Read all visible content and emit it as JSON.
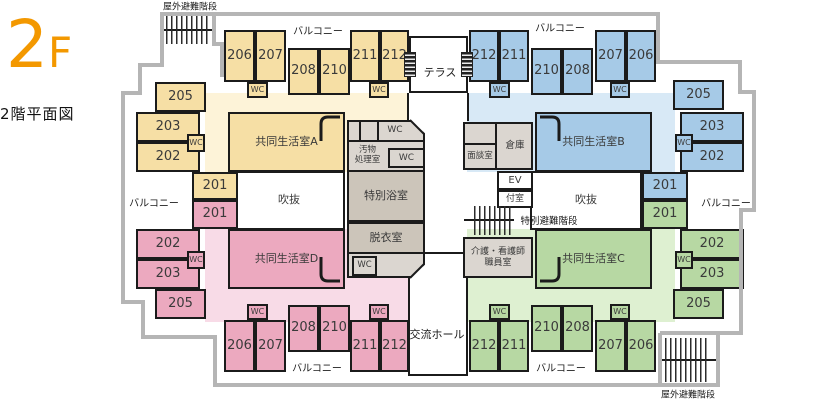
{
  "title": {
    "floor_big": "2",
    "floor_small": "F",
    "caption": "2階平面図"
  },
  "palette": {
    "roomY": "#f6dfa5",
    "tintY": "#fdf3d8",
    "roomB": "#a6cae7",
    "tintB": "#d8e9f6",
    "roomP": "#eca9bf",
    "tintP": "#f8dbe7",
    "roomG": "#b7d8a3",
    "tintG": "#def0d1",
    "grayL": "#dbd6d0",
    "grayD": "#ccc5ba",
    "white": "#ffffff",
    "wall": "#1b1b1b",
    "outline": "#b5b5b5",
    "accent": "#f39800"
  },
  "areas": [
    {
      "id": "himawari",
      "name": "[ひまわり]",
      "suffix": "エリア",
      "color": "#ef8200"
    },
    {
      "id": "tsubaki",
      "name": "[つばき]",
      "suffix": "エリア",
      "color": "#1d6fba"
    },
    {
      "id": "sumire",
      "name": "[すみれ]",
      "suffix": "エリア",
      "color": "#e4007f"
    },
    {
      "id": "tanpopo",
      "name": "[たんぽぽ]",
      "suffix": "エリア",
      "color": "#22a23c"
    }
  ],
  "plan": {
    "rects": [
      {
        "n": "himawari-area-tint",
        "x": 205,
        "y": 93,
        "w": 204,
        "h": 79,
        "f": "tintY"
      },
      {
        "n": "tsubaki-area-tint",
        "x": 467,
        "y": 93,
        "w": 208,
        "h": 79,
        "f": "tintB"
      },
      {
        "n": "sumire-area-tint",
        "x": 205,
        "y": 229,
        "w": 204,
        "h": 93,
        "f": "tintP"
      },
      {
        "n": "tanpopo-area-tint",
        "x": 467,
        "y": 229,
        "w": 208,
        "h": 93,
        "f": "tintG"
      },
      {
        "n": "terrace",
        "x": 409,
        "y": 36,
        "w": 59,
        "h": 57,
        "f": "white",
        "b": 1
      },
      {
        "n": "atrium-left",
        "t": "吹抜",
        "x": 233,
        "y": 171,
        "w": 112,
        "h": 59,
        "f": "white",
        "fs": 11,
        "b": 1
      },
      {
        "n": "atrium-right",
        "t": "吹抜",
        "x": 530,
        "y": 171,
        "w": 112,
        "h": 59,
        "f": "white",
        "fs": 11,
        "b": 1
      },
      {
        "n": "exchange-hall",
        "x": 408,
        "y": 252,
        "w": 60,
        "h": 124,
        "f": "white",
        "b": 1
      },
      {
        "n": "elevator",
        "t": "EV",
        "x": 497,
        "y": 171,
        "w": 36,
        "h": 19,
        "f": "white",
        "fs": 10,
        "b": 1
      },
      {
        "n": "anteroom",
        "t": "付室",
        "x": 497,
        "y": 190,
        "w": 36,
        "h": 18,
        "f": "white",
        "fs": 9,
        "b": 1
      },
      {
        "n": "sanitary-block",
        "x": 347,
        "y": 120,
        "w": 78,
        "h": 158,
        "f": "grayL",
        "b": 1,
        "clip": "sani"
      },
      {
        "n": "sanitary-row1-wall",
        "x": 347,
        "y": 140,
        "w": 78,
        "h": 2,
        "f": "wall"
      },
      {
        "n": "sanitary-divider-1",
        "x": 359,
        "y": 120,
        "w": 2,
        "h": 22,
        "f": "wall"
      },
      {
        "n": "sanitary-divider-2",
        "x": 377,
        "y": 120,
        "w": 2,
        "h": 22,
        "f": "wall"
      },
      {
        "n": "wc-sanitary-top",
        "t": "WC",
        "x": 379,
        "y": 120,
        "w": 32,
        "h": 21,
        "fs": 9
      },
      {
        "n": "soiled-utility-room",
        "t": "汚物\n処理室",
        "x": 347,
        "y": 142,
        "w": 41,
        "h": 28,
        "fs": 8.5
      },
      {
        "n": "wc-sanitary-mid",
        "t": "WC",
        "x": 388,
        "y": 148,
        "w": 37,
        "h": 20,
        "f": "grayL",
        "fs": 9,
        "b": 1
      },
      {
        "n": "special-bathroom",
        "t": "特別浴室",
        "x": 347,
        "y": 170,
        "w": 78,
        "h": 52,
        "f": "grayD",
        "fs": 11,
        "b": 1
      },
      {
        "n": "undressing-room",
        "t": "脱衣室",
        "x": 347,
        "y": 222,
        "w": 78,
        "h": 32,
        "f": "grayD",
        "fs": 11,
        "b": 1
      },
      {
        "n": "wc-sanitary-bottom",
        "t": "WC",
        "x": 352,
        "y": 256,
        "w": 25,
        "h": 20,
        "f": "grayL",
        "fs": 8.5,
        "b": 1
      },
      {
        "n": "consult-block",
        "x": 463,
        "y": 122,
        "w": 70,
        "h": 48,
        "f": "grayL",
        "b": 1
      },
      {
        "n": "consult-divider-v",
        "x": 495,
        "y": 122,
        "w": 2,
        "h": 48,
        "f": "wall"
      },
      {
        "n": "consult-divider-h",
        "x": 463,
        "y": 143,
        "w": 34,
        "h": 2,
        "f": "wall"
      },
      {
        "n": "interview-room",
        "t": "面談室",
        "x": 464,
        "y": 145,
        "w": 32,
        "h": 24,
        "fs": 8.5
      },
      {
        "n": "storage-room",
        "t": "倉庫",
        "x": 497,
        "y": 122,
        "w": 36,
        "h": 48,
        "fs": 9.5
      },
      {
        "n": "care-staff-room",
        "t": "介護・看護師\n職員室",
        "x": 463,
        "y": 237,
        "w": 70,
        "h": 41,
        "f": "grayL",
        "fs": 9,
        "b": 1
      },
      {
        "n": "room-206-himawari",
        "t": "206",
        "x": 224,
        "y": 30,
        "w": 31,
        "h": 52,
        "f": "roomY",
        "fs": 13,
        "b": 1
      },
      {
        "n": "room-207-himawari",
        "t": "207",
        "x": 255,
        "y": 30,
        "w": 31,
        "h": 52,
        "f": "roomY",
        "fs": 13,
        "b": 1
      },
      {
        "n": "wc-himawari-1",
        "t": "WC",
        "x": 247,
        "y": 82,
        "w": 21,
        "h": 16,
        "f": "roomY",
        "fs": 8,
        "b": 1
      },
      {
        "n": "room-208-himawari",
        "t": "208",
        "x": 288,
        "y": 48,
        "w": 31,
        "h": 47,
        "f": "roomY",
        "fs": 13,
        "b": 1
      },
      {
        "n": "room-210-himawari",
        "t": "210",
        "x": 319,
        "y": 48,
        "w": 31,
        "h": 47,
        "f": "roomY",
        "fs": 13,
        "b": 1
      },
      {
        "n": "room-211-himawari",
        "t": "211",
        "x": 350,
        "y": 30,
        "w": 30,
        "h": 52,
        "f": "roomY",
        "fs": 13,
        "b": 1
      },
      {
        "n": "room-212-himawari",
        "t": "212",
        "x": 380,
        "y": 30,
        "w": 29,
        "h": 52,
        "f": "roomY",
        "fs": 13,
        "b": 1
      },
      {
        "n": "wc-himawari-2",
        "t": "WC",
        "x": 369,
        "y": 82,
        "w": 20,
        "h": 16,
        "f": "roomY",
        "fs": 8,
        "b": 1
      },
      {
        "n": "room-205-himawari",
        "t": "205",
        "x": 155,
        "y": 82,
        "w": 51,
        "h": 30,
        "f": "roomY",
        "fs": 13,
        "b": 1
      },
      {
        "n": "room-203-himawari",
        "t": "203",
        "x": 136,
        "y": 112,
        "w": 64,
        "h": 30,
        "f": "roomY",
        "fs": 13,
        "b": 1
      },
      {
        "n": "room-202-himawari",
        "t": "202",
        "x": 136,
        "y": 142,
        "w": 64,
        "h": 30,
        "f": "roomY",
        "fs": 13,
        "b": 1
      },
      {
        "n": "wc-himawari-3",
        "t": "WC",
        "x": 187,
        "y": 134,
        "w": 18,
        "h": 18,
        "f": "roomY",
        "fs": 8,
        "b": 1
      },
      {
        "n": "room-201-himawari",
        "t": "201",
        "x": 192,
        "y": 172,
        "w": 46,
        "h": 28,
        "f": "roomY",
        "fs": 13,
        "b": 1
      },
      {
        "n": "living-room-a",
        "t": "共同生活室A",
        "x": 228,
        "y": 112,
        "w": 117,
        "h": 60,
        "f": "roomY",
        "fs": 11,
        "b": 1
      },
      {
        "n": "room-201-sumire",
        "t": "201",
        "x": 192,
        "y": 200,
        "w": 46,
        "h": 29,
        "f": "roomP",
        "fs": 13,
        "b": 1
      },
      {
        "n": "room-202-sumire",
        "t": "202",
        "x": 136,
        "y": 229,
        "w": 64,
        "h": 30,
        "f": "roomP",
        "fs": 13,
        "b": 1
      },
      {
        "n": "room-203-sumire",
        "t": "203",
        "x": 136,
        "y": 259,
        "w": 64,
        "h": 30,
        "f": "roomP",
        "fs": 13,
        "b": 1
      },
      {
        "n": "wc-sumire-3",
        "t": "WC",
        "x": 187,
        "y": 251,
        "w": 18,
        "h": 18,
        "f": "roomP",
        "fs": 8,
        "b": 1
      },
      {
        "n": "room-205-sumire",
        "t": "205",
        "x": 155,
        "y": 289,
        "w": 51,
        "h": 30,
        "f": "roomP",
        "fs": 13,
        "b": 1
      },
      {
        "n": "living-room-d",
        "t": "共同生活室D",
        "x": 228,
        "y": 229,
        "w": 117,
        "h": 60,
        "f": "roomP",
        "fs": 11,
        "b": 1
      },
      {
        "n": "room-206-sumire",
        "t": "206",
        "x": 224,
        "y": 320,
        "w": 31,
        "h": 52,
        "f": "roomP",
        "fs": 13,
        "b": 1
      },
      {
        "n": "room-207-sumire",
        "t": "207",
        "x": 255,
        "y": 320,
        "w": 31,
        "h": 52,
        "f": "roomP",
        "fs": 13,
        "b": 1
      },
      {
        "n": "wc-sumire-1",
        "t": "WC",
        "x": 247,
        "y": 304,
        "w": 21,
        "h": 16,
        "f": "roomP",
        "fs": 8,
        "b": 1
      },
      {
        "n": "room-208-sumire",
        "t": "208",
        "x": 288,
        "y": 305,
        "w": 31,
        "h": 47,
        "f": "roomP",
        "fs": 13,
        "b": 1
      },
      {
        "n": "room-210-sumire",
        "t": "210",
        "x": 319,
        "y": 305,
        "w": 31,
        "h": 47,
        "f": "roomP",
        "fs": 13,
        "b": 1
      },
      {
        "n": "room-211-sumire",
        "t": "211",
        "x": 350,
        "y": 320,
        "w": 30,
        "h": 52,
        "f": "roomP",
        "fs": 13,
        "b": 1
      },
      {
        "n": "room-212-sumire",
        "t": "212",
        "x": 380,
        "y": 320,
        "w": 29,
        "h": 52,
        "f": "roomP",
        "fs": 13,
        "b": 1
      },
      {
        "n": "wc-sumire-2",
        "t": "WC",
        "x": 369,
        "y": 304,
        "w": 20,
        "h": 16,
        "f": "roomP",
        "fs": 8,
        "b": 1
      },
      {
        "n": "room-212-tsubaki",
        "t": "212",
        "x": 469,
        "y": 30,
        "w": 30,
        "h": 52,
        "f": "roomB",
        "fs": 13,
        "b": 1
      },
      {
        "n": "room-211-tsubaki",
        "t": "211",
        "x": 499,
        "y": 30,
        "w": 30,
        "h": 52,
        "f": "roomB",
        "fs": 13,
        "b": 1
      },
      {
        "n": "wc-tsubaki-1",
        "t": "WC",
        "x": 489,
        "y": 82,
        "w": 21,
        "h": 16,
        "f": "roomB",
        "fs": 8,
        "b": 1
      },
      {
        "n": "room-210-tsubaki",
        "t": "210",
        "x": 531,
        "y": 48,
        "w": 31,
        "h": 47,
        "f": "roomB",
        "fs": 13,
        "b": 1
      },
      {
        "n": "room-208-tsubaki",
        "t": "208",
        "x": 562,
        "y": 48,
        "w": 31,
        "h": 47,
        "f": "roomB",
        "fs": 13,
        "b": 1
      },
      {
        "n": "room-207-tsubaki",
        "t": "207",
        "x": 595,
        "y": 30,
        "w": 31,
        "h": 52,
        "f": "roomB",
        "fs": 13,
        "b": 1
      },
      {
        "n": "room-206-tsubaki",
        "t": "206",
        "x": 626,
        "y": 30,
        "w": 30,
        "h": 52,
        "f": "roomB",
        "fs": 13,
        "b": 1
      },
      {
        "n": "wc-tsubaki-2",
        "t": "WC",
        "x": 610,
        "y": 82,
        "w": 20,
        "h": 16,
        "f": "roomB",
        "fs": 8,
        "b": 1
      },
      {
        "n": "room-205-tsubaki",
        "t": "205",
        "x": 673,
        "y": 80,
        "w": 51,
        "h": 30,
        "f": "roomB",
        "fs": 13,
        "b": 1
      },
      {
        "n": "room-203-tsubaki",
        "t": "203",
        "x": 680,
        "y": 112,
        "w": 64,
        "h": 30,
        "f": "roomB",
        "fs": 13,
        "b": 1
      },
      {
        "n": "room-202-tsubaki",
        "t": "202",
        "x": 680,
        "y": 142,
        "w": 64,
        "h": 30,
        "f": "roomB",
        "fs": 13,
        "b": 1
      },
      {
        "n": "wc-tsubaki-3",
        "t": "WC",
        "x": 675,
        "y": 134,
        "w": 18,
        "h": 18,
        "f": "roomB",
        "fs": 8,
        "b": 1
      },
      {
        "n": "room-201-tsubaki",
        "t": "201",
        "x": 642,
        "y": 172,
        "w": 46,
        "h": 28,
        "f": "roomB",
        "fs": 13,
        "b": 1
      },
      {
        "n": "living-room-b",
        "t": "共同生活室B",
        "x": 535,
        "y": 112,
        "w": 117,
        "h": 60,
        "f": "roomB",
        "fs": 11,
        "b": 1
      },
      {
        "n": "room-201-tanpopo",
        "t": "201",
        "x": 642,
        "y": 200,
        "w": 46,
        "h": 29,
        "f": "roomG",
        "fs": 13,
        "b": 1
      },
      {
        "n": "room-202-tanpopo",
        "t": "202",
        "x": 680,
        "y": 229,
        "w": 64,
        "h": 30,
        "f": "roomG",
        "fs": 13,
        "b": 1
      },
      {
        "n": "room-203-tanpopo",
        "t": "203",
        "x": 680,
        "y": 259,
        "w": 64,
        "h": 30,
        "f": "roomG",
        "fs": 13,
        "b": 1
      },
      {
        "n": "wc-tanpopo-3",
        "t": "WC",
        "x": 675,
        "y": 251,
        "w": 18,
        "h": 18,
        "f": "roomG",
        "fs": 8,
        "b": 1
      },
      {
        "n": "room-205-tanpopo",
        "t": "205",
        "x": 673,
        "y": 289,
        "w": 51,
        "h": 30,
        "f": "roomG",
        "fs": 13,
        "b": 1
      },
      {
        "n": "living-room-c",
        "t": "共同生活室C",
        "x": 535,
        "y": 229,
        "w": 117,
        "h": 60,
        "f": "roomG",
        "fs": 11,
        "b": 1
      },
      {
        "n": "room-212-tanpopo",
        "t": "212",
        "x": 469,
        "y": 320,
        "w": 30,
        "h": 52,
        "f": "roomG",
        "fs": 13,
        "b": 1
      },
      {
        "n": "room-211-tanpopo",
        "t": "211",
        "x": 499,
        "y": 320,
        "w": 30,
        "h": 52,
        "f": "roomG",
        "fs": 13,
        "b": 1
      },
      {
        "n": "wc-tanpopo-1",
        "t": "WC",
        "x": 489,
        "y": 304,
        "w": 21,
        "h": 16,
        "f": "roomG",
        "fs": 8,
        "b": 1
      },
      {
        "n": "room-210-tanpopo",
        "t": "210",
        "x": 531,
        "y": 305,
        "w": 31,
        "h": 47,
        "f": "roomG",
        "fs": 13,
        "b": 1
      },
      {
        "n": "room-208-tanpopo",
        "t": "208",
        "x": 562,
        "y": 305,
        "w": 31,
        "h": 47,
        "f": "roomG",
        "fs": 13,
        "b": 1
      },
      {
        "n": "room-207-tanpopo",
        "t": "207",
        "x": 595,
        "y": 320,
        "w": 31,
        "h": 52,
        "f": "roomG",
        "fs": 13,
        "b": 1
      },
      {
        "n": "room-206-tanpopo",
        "t": "206",
        "x": 626,
        "y": 320,
        "w": 30,
        "h": 52,
        "f": "roomG",
        "fs": 13,
        "b": 1
      },
      {
        "n": "wc-tanpopo-2",
        "t": "WC",
        "x": 610,
        "y": 304,
        "w": 20,
        "h": 16,
        "f": "roomG",
        "fs": 8,
        "b": 1
      }
    ],
    "walls": [
      {
        "n": "terrace-left-wall",
        "x": 407,
        "y": 93,
        "w": 2,
        "h": 28
      },
      {
        "n": "terrace-right-wall",
        "x": 467,
        "y": 93,
        "w": 2,
        "h": 28
      },
      {
        "n": "sanitary-cut-top",
        "x": 410,
        "y": 119,
        "w": 20,
        "h": 2,
        "rot": 45
      },
      {
        "n": "sanitary-cut-bottom",
        "x": 410,
        "y": 277,
        "w": 20,
        "h": 2,
        "rot": -45
      },
      {
        "n": "stairs-top-rail",
        "x": 161,
        "y": 29,
        "w": 55,
        "h": 2
      },
      {
        "n": "stairs-bottom-rail",
        "x": 659,
        "y": 359,
        "w": 60,
        "h": 2
      },
      {
        "n": "stairs-center-rail",
        "x": 464,
        "y": 219,
        "w": 50,
        "h": 2
      }
    ],
    "hatches": [
      {
        "n": "outdoor-stairs-top-icon",
        "x": 166,
        "y": 16,
        "w": 42,
        "h": 28,
        "type": "v"
      },
      {
        "n": "outdoor-stairs-bottom-icon",
        "x": 665,
        "y": 338,
        "w": 45,
        "h": 44,
        "type": "v"
      },
      {
        "n": "special-escape-stairs-icon",
        "x": 474,
        "y": 206,
        "w": 38,
        "h": 29,
        "type": "v"
      },
      {
        "n": "terrace-step-left-icon",
        "x": 404,
        "y": 52,
        "w": 10,
        "h": 23,
        "type": "h"
      },
      {
        "n": "terrace-step-right-icon",
        "x": 461,
        "y": 52,
        "w": 10,
        "h": 23,
        "type": "h"
      }
    ],
    "labels": [
      {
        "n": "balcony-label-top-left",
        "t": "バルコニー",
        "x": 318,
        "y": 30,
        "fs": 10
      },
      {
        "n": "balcony-label-top-right",
        "t": "バルコニー",
        "x": 560,
        "y": 27,
        "fs": 10
      },
      {
        "n": "balcony-label-left",
        "t": "バルコニー",
        "x": 154,
        "y": 202,
        "fs": 10
      },
      {
        "n": "balcony-label-right",
        "t": "バルコニー",
        "x": 726,
        "y": 202,
        "fs": 10
      },
      {
        "n": "balcony-label-bottom-left",
        "t": "バルコニー",
        "x": 317,
        "y": 367,
        "fs": 10
      },
      {
        "n": "balcony-label-bottom-right",
        "t": "バルコニー",
        "x": 561,
        "y": 367,
        "fs": 10
      },
      {
        "n": "terrace-label",
        "t": "テラス",
        "x": 440,
        "y": 72,
        "fs": 11
      },
      {
        "n": "exchange-hall-label",
        "t": "交流ホール",
        "x": 437,
        "y": 334,
        "fs": 11
      },
      {
        "n": "outdoor-stairs-top-label",
        "t": "屋外避難階段",
        "x": 190,
        "y": 6,
        "fs": 9
      },
      {
        "n": "outdoor-stairs-bottom-label",
        "t": "屋外避難階段",
        "x": 688,
        "y": 394,
        "fs": 9
      },
      {
        "n": "special-escape-stairs-label",
        "t": "特別避難階段",
        "x": 549,
        "y": 220,
        "fs": 9.5
      }
    ]
  }
}
